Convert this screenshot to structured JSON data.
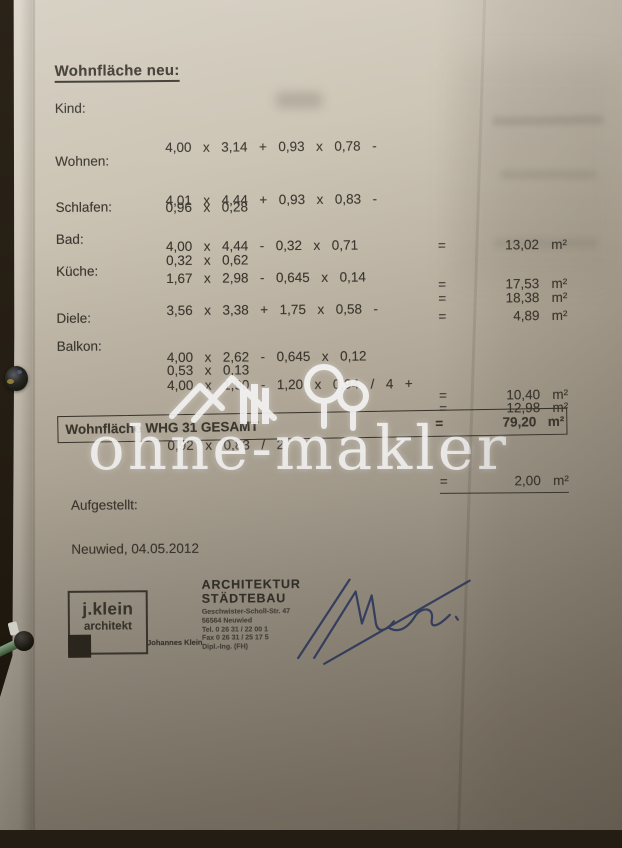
{
  "heading": "Wohnfläche neu:",
  "symbols": {
    "eq": "=",
    "unit": "m²"
  },
  "rows": [
    {
      "label": "Kind:",
      "line1": "4,00  x  3,14  +  0,93  x  0,78  -",
      "line2": "0,96  x  0,28",
      "value": "13,02"
    },
    {
      "label": "Wohnen:",
      "line1": "4,01  x  4,44  +  0,93  x  0,83  -",
      "line2": "0,32  x  0,62",
      "value": "18,38"
    },
    {
      "label": "Schlafen:",
      "line1": "4,00  x  4,44  -  0,32  x  0,71",
      "line2": "",
      "value": "17,53"
    },
    {
      "label": "Bad:",
      "line1": "1,67  x  2,98  -  0,645  x  0,14",
      "line2": "",
      "value": "4,89"
    },
    {
      "label": "Küche:",
      "line1": "3,56  x  3,38  +  1,75  x  0,58  -",
      "line2": "0,53  x  0,13",
      "value": "12,98"
    },
    {
      "label": "Diele:",
      "line1": "4,00  x  2,62  -  0,645  x  0,12",
      "line2": "",
      "value": "10,40"
    },
    {
      "label": "Balkon:",
      "line1": "4,00  x  1,90  -  1,20  x  0,94  /  4  +",
      "line2": "0,92  x  0,83  /  2",
      "value": "2,00"
    }
  ],
  "total": {
    "label": "Wohnfläche WHG 31 GESAMT",
    "value": "79,20"
  },
  "footer": {
    "aufgestellt_label": "Aufgestellt:",
    "place_date": "Neuwied, 04.05.2012",
    "stamp": {
      "line1": "j.klein",
      "line2": "architekt",
      "person": "Johannes Klein"
    },
    "office": {
      "line1": "ARCHITEKTUR",
      "line2": "STÄDTEBAU",
      "street": "Geschwister-Scholl-Str. 47",
      "city": "56564 Neuwied",
      "tel": "Tel. 0 26 31 / 22 00 1",
      "fax": "Fax 0 26 31 / 25 17 5",
      "degree": "Dipl.-Ing. (FH)"
    }
  },
  "watermark": {
    "text": "ohne-makler",
    "logo": "house-and-trees"
  },
  "colors": {
    "paper_top": "#d4cdbf",
    "paper_bottom": "#887f70",
    "background": "#231c12",
    "ink": "#3b372f",
    "watermark": "#ffffff",
    "signature": "#2c3a66"
  }
}
